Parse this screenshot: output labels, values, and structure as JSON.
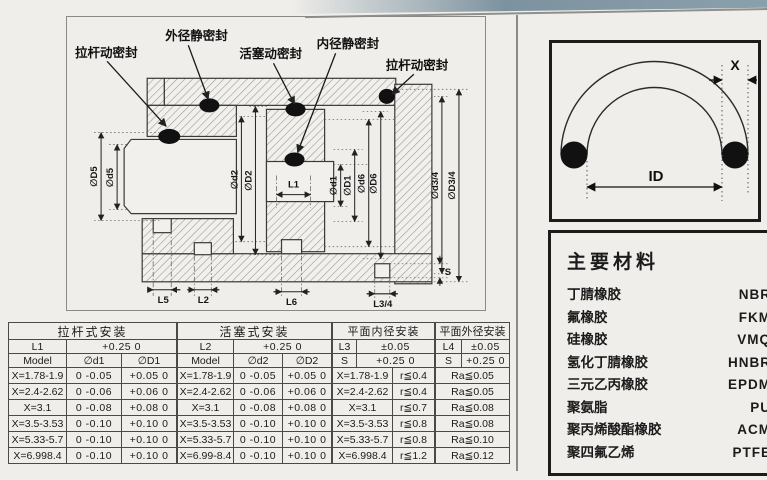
{
  "diagram": {
    "callouts": {
      "rod_seal_left": "拉杆动密封",
      "outer_static_seal": "外径静密封",
      "piston_seal": "活塞动密封",
      "inner_static_seal": "内径静密封",
      "rod_seal_right": "拉杆动密封"
    },
    "dims": {
      "D5": "∅D5",
      "d5": "∅d5",
      "d2": "∅d2",
      "D2": "∅D2",
      "L1": "L1",
      "d1": "∅d1",
      "D1": "∅D1",
      "d6": "∅d6",
      "D6": "∅D6",
      "d34": "∅d3/4",
      "D34": "∅D3/4",
      "S": "S",
      "L5": "L5",
      "L2": "L2",
      "L6": "L6",
      "L34": "L3/4"
    }
  },
  "oring_figure": {
    "x_label": "X",
    "id_label": "ID"
  },
  "materials": {
    "title": "主要材料",
    "items": [
      {
        "name": "丁腈橡胶",
        "code": "NBR"
      },
      {
        "name": "氟橡胶",
        "code": "FKM"
      },
      {
        "name": "硅橡胶",
        "code": "VMQ"
      },
      {
        "name": "氢化丁腈橡胶",
        "code": "HNBR"
      },
      {
        "name": "三元乙丙橡胶",
        "code": "EPDM"
      },
      {
        "name": "聚氨脂",
        "code": "PU"
      },
      {
        "name": "聚丙烯酸酯橡胶",
        "code": "ACM"
      },
      {
        "name": "聚四氟乙烯",
        "code": "PTFE"
      }
    ]
  },
  "tables": {
    "rod": {
      "title": "拉杆式安装",
      "l_label": "L1",
      "l_tol": "+0.25  0",
      "col_model": "Model",
      "col_d": "∅d1",
      "col_D": "∅D1",
      "rows": [
        {
          "model": "X=1.78-1.9",
          "d": "0  -0.05",
          "D": "+0.05  0"
        },
        {
          "model": "X=2.4-2.62",
          "d": "0  -0.06",
          "D": "+0.06  0"
        },
        {
          "model": "X=3.1",
          "d": "0  -0.08",
          "D": "+0.08  0"
        },
        {
          "model": "X=3.5-3.53",
          "d": "0  -0.10",
          "D": "+0.10  0"
        },
        {
          "model": "X=5.33-5.7",
          "d": "0  -0.10",
          "D": "+0.10  0"
        },
        {
          "model": "X=6.998.4",
          "d": "0  -0.10",
          "D": "+0.10  0"
        }
      ]
    },
    "piston": {
      "title": "活塞式安装",
      "l_label": "L2",
      "l_tol": "+0.25  0",
      "col_model": "Model",
      "col_d": "∅d2",
      "col_D": "∅D2",
      "rows": [
        {
          "model": "X=1.78-1.9",
          "d": "0  -0.05",
          "D": "+0.05  0"
        },
        {
          "model": "X=2.4-2.62",
          "d": "0  -0.06",
          "D": "+0.06  0"
        },
        {
          "model": "X=3.1",
          "d": "0  -0.08",
          "D": "+0.08  0"
        },
        {
          "model": "X=3.5-3.53",
          "d": "0  -0.10",
          "D": "+0.10  0"
        },
        {
          "model": "X=5.33-5.7",
          "d": "0  -0.10",
          "D": "+0.10  0"
        },
        {
          "model": "X=6.99-8.4",
          "d": "0  -0.10",
          "D": "+0.10  0"
        }
      ]
    },
    "flat_inner": {
      "title": "平面内径安装",
      "l_label": "L3",
      "l_tol": "±0.05",
      "s_label": "S",
      "s_tol": "+0.25  0",
      "rows": [
        {
          "model": "X=1.78-1.9",
          "r": "r≦0.4"
        },
        {
          "model": "X=2.4-2.62",
          "r": "r≦0.4"
        },
        {
          "model": "X=3.1",
          "r": "r≦0.7"
        },
        {
          "model": "X=3.5-3.53",
          "r": "r≦0.8"
        },
        {
          "model": "X=5.33-5.7",
          "r": "r≦0.8"
        },
        {
          "model": "X=6.998.4",
          "r": "r≦1.2"
        }
      ]
    },
    "flat_outer": {
      "title": "平面外径安装",
      "l_label": "L4",
      "l_tol": "±0.05",
      "s_label": "S",
      "s_tol": "+0.25  0",
      "rows": [
        {
          "ra": "Ra≦0.05"
        },
        {
          "ra": "Ra≦0.05"
        },
        {
          "ra": "Ra≦0.08"
        },
        {
          "ra": "Ra≦0.08"
        },
        {
          "ra": "Ra≦0.10"
        },
        {
          "ra": "Ra≦0.12"
        }
      ]
    }
  }
}
